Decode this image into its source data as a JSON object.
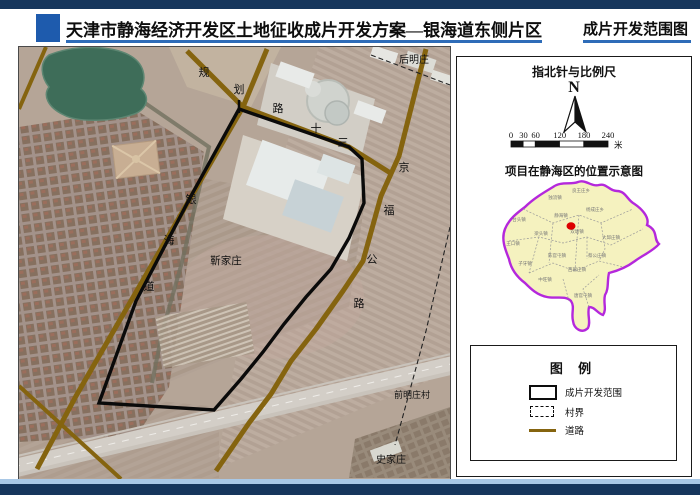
{
  "header": {
    "title_left": "天津市静海经济开发区土地征收成片开发方案—银海道东侧片区",
    "title_right": "成片开发范围图"
  },
  "map": {
    "labels": [
      "规",
      "划",
      "路",
      "十",
      "三",
      "银",
      "海",
      "道",
      "京",
      "福",
      "公",
      "路",
      "后明庄",
      "靳家庄",
      "前明庄村",
      "史家庄"
    ]
  },
  "panel": {
    "compass_title": "指北针与比例尺",
    "north_label": "N",
    "scale_ticks": [
      "0",
      "30",
      "60",
      "120",
      "180",
      "240"
    ],
    "scale_unit": "米",
    "location_title": "项目在静海区的位置示意图",
    "legend_title": "图 例",
    "legend": [
      {
        "label": "成片开发范围"
      },
      {
        "label": "村界"
      },
      {
        "label": "道路"
      }
    ],
    "districts": [
      "独流镇",
      "良王庄乡",
      "台头镇",
      "王口镇",
      "静海镇",
      "杨成庄乡",
      "双塘镇",
      "梁头镇",
      "大邱庄镇",
      "子牙镇",
      "陈官屯镇",
      "西翟庄镇",
      "蔡公庄镇",
      "中旺镇",
      "唐官屯镇"
    ]
  },
  "colors": {
    "navy_bar": "#16365c",
    "accent_blue": "#2e6cb8",
    "logo_blue": "#1e5bad",
    "road_olive": "#85640f",
    "scope_black": "#0a0a0a",
    "district_border_purple": "#b428dc",
    "district_fill_yellow": "#f5f2bf",
    "project_dot_red": "#dd0000"
  }
}
